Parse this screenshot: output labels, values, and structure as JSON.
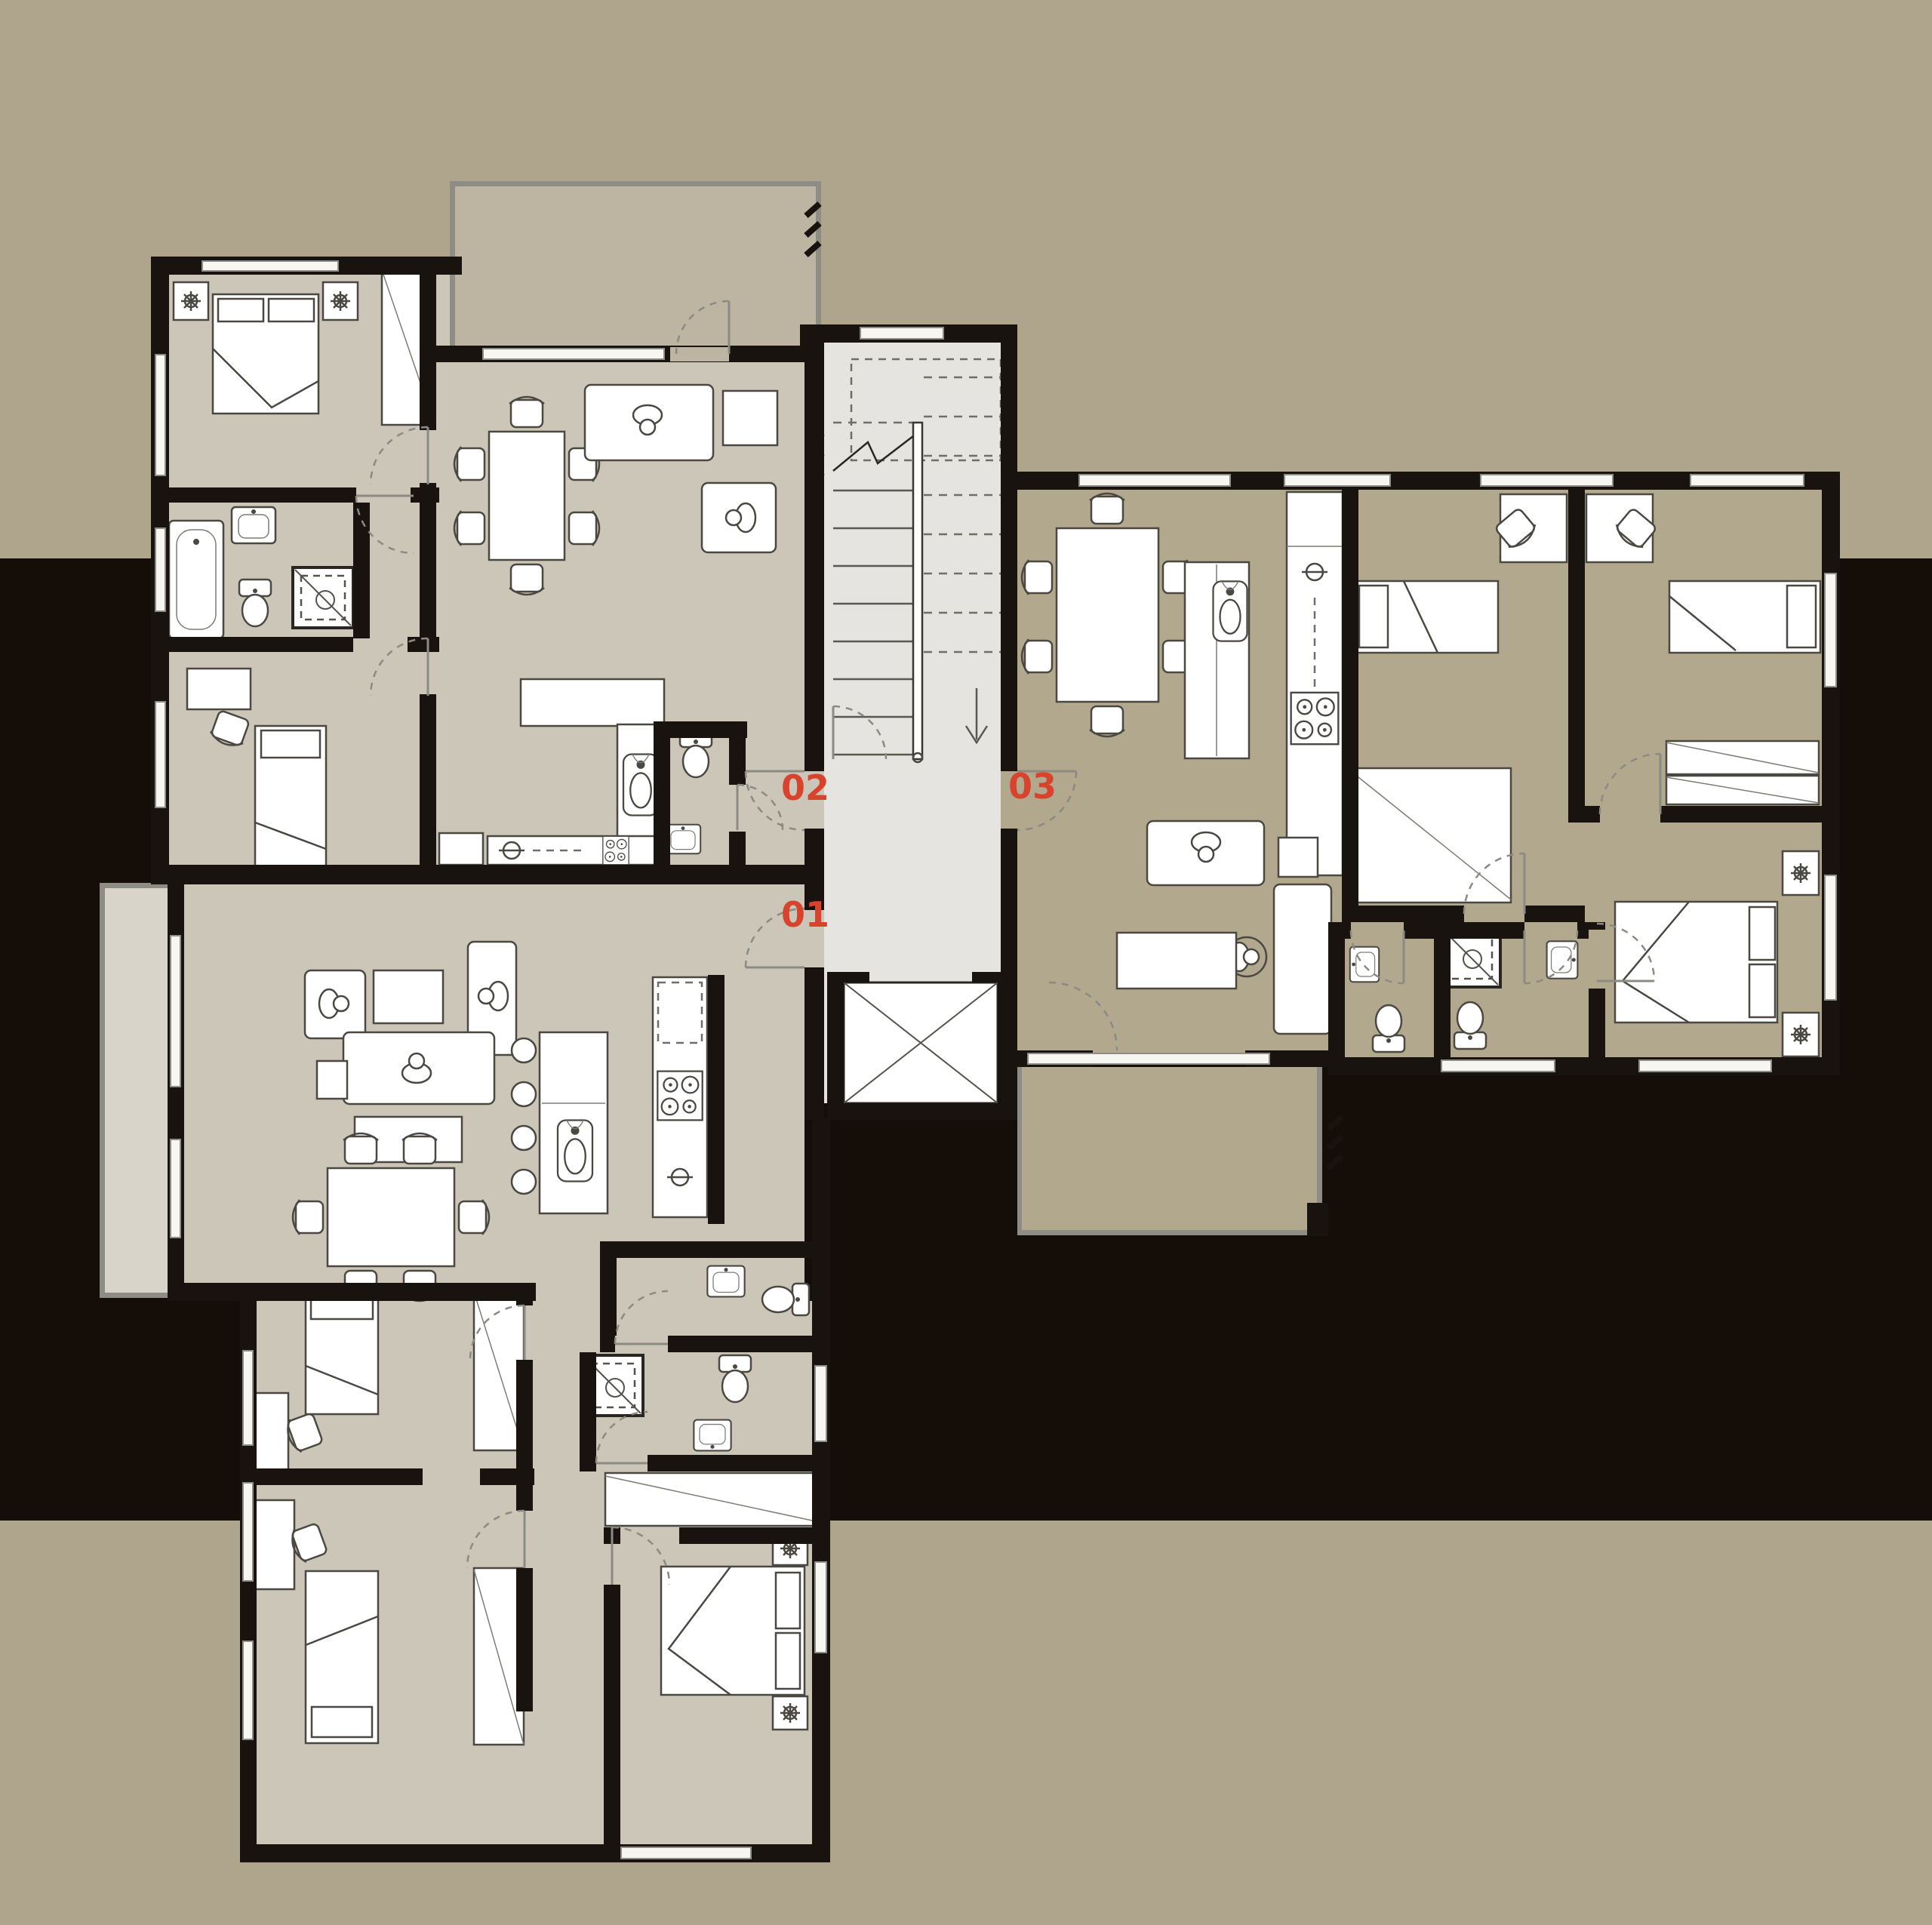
{
  "document": {
    "kind": "architectural floor plan",
    "description": "Upper floor plan of a residential building: three apartments arranged around a central staircase, entrance hall and elevator core, drawn on a tan background with a dark horizontal band",
    "visible_text": [
      "02",
      "03",
      "01"
    ]
  },
  "units": [
    {
      "label": "01",
      "position": "lower-left apartment",
      "entry": "hall left-bottom door"
    },
    {
      "label": "02",
      "position": "upper-left apartment",
      "entry": "hall left-top door"
    },
    {
      "label": "03",
      "position": "right apartment",
      "entry": "hall right door"
    }
  ],
  "core": {
    "features": [
      "staircase",
      "entrance-hall",
      "elevator"
    ]
  },
  "palette": {
    "wall": "#18130e",
    "bg-band": "#aea58c",
    "bg-dark": "#150e08",
    "floor-light": "#ccc6b8",
    "floor-tan": "#b2a88e",
    "floor-core": "#e5e4e0",
    "balcony-light": "#d8d4c9",
    "balcony-mid": "#bdb5a2",
    "window-fill": "#f7f6f3",
    "furniture-stroke": "#4b4842",
    "accent-label": "#d8432d"
  }
}
